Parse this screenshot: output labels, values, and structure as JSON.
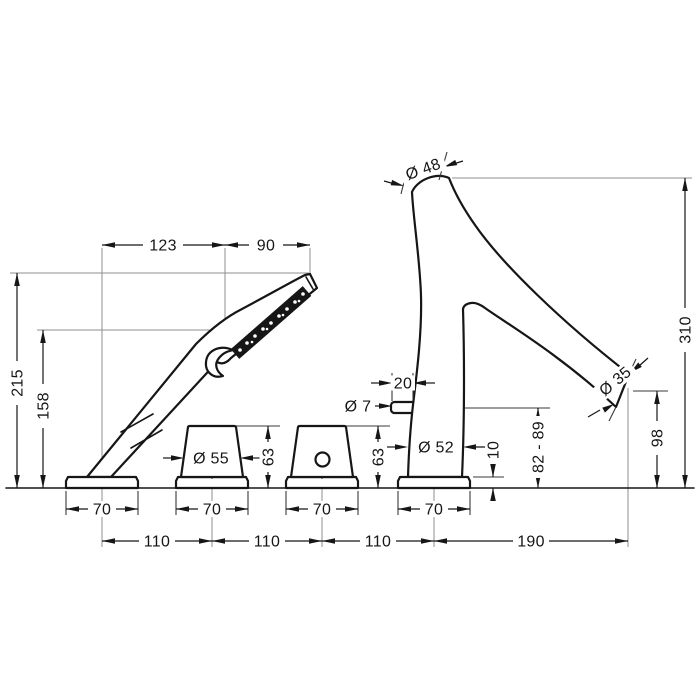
{
  "diagram": {
    "kind": "technical-dimension-drawing",
    "colors": {
      "line": "#161616",
      "projection": "#8f8f8f",
      "background": "#ffffff"
    },
    "labels": {
      "dim_123": "123",
      "dim_90": "90",
      "dim_215": "215",
      "dim_158": "158",
      "dim_d48": "Ø 48",
      "dim_310": "310",
      "dim_d35": "Ø 35",
      "dim_98": "98",
      "dim_20": "20",
      "dim_d7": "Ø 7",
      "dim_d55": "Ø 55",
      "dim_63_left": "63",
      "dim_63_right": "63",
      "dim_d52": "Ø 52",
      "dim_10": "10",
      "dim_82_89": "82 - 89",
      "dim_70_1": "70",
      "dim_70_2": "70",
      "dim_70_3": "70",
      "dim_70_4": "70",
      "dim_110_1": "110",
      "dim_110_2": "110",
      "dim_110_3": "110",
      "dim_190": "190"
    }
  }
}
